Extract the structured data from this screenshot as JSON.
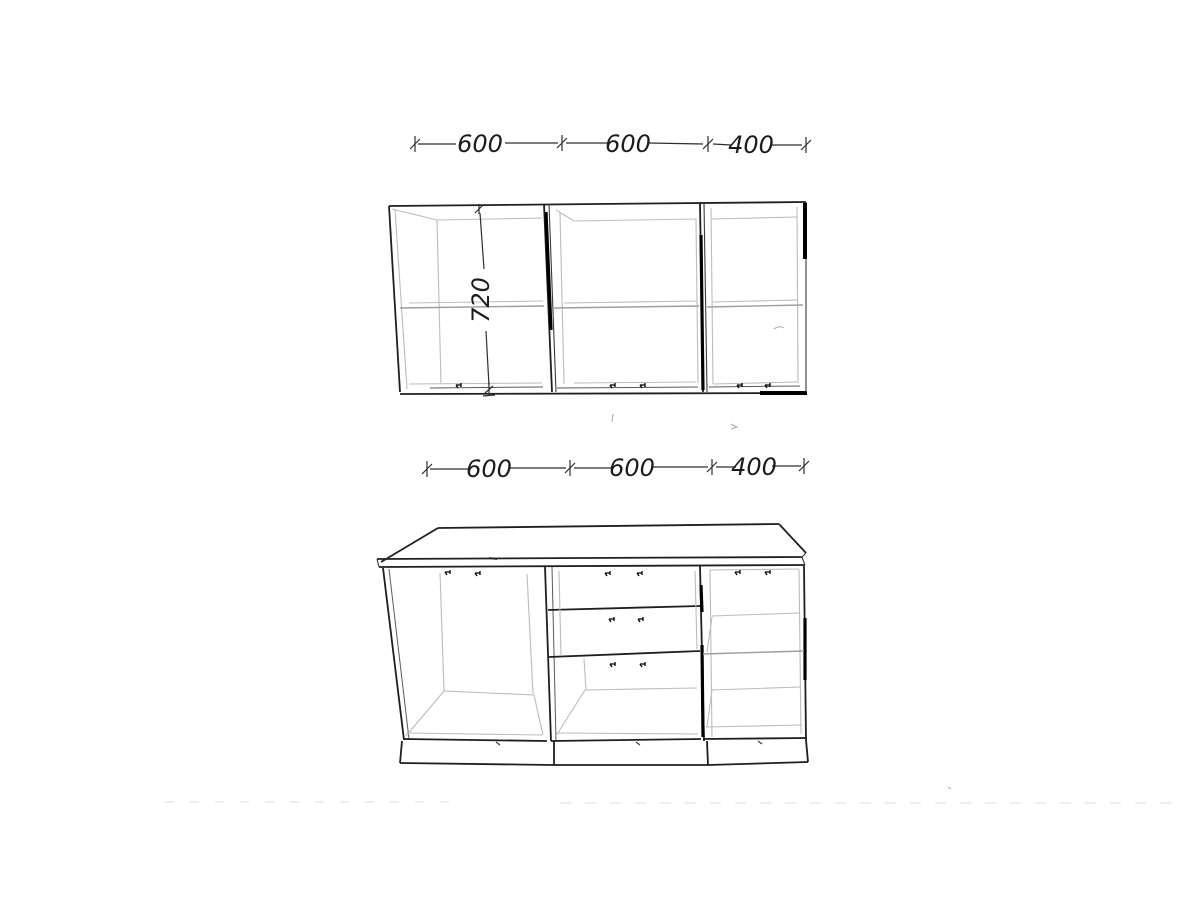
{
  "colors": {
    "background": "#ffffff",
    "line_dark": "#1f1f1f",
    "line_light": "#bcbcbc",
    "line_bold": "#000000",
    "text": "#1c1c1c"
  },
  "wall_run": {
    "dimension_labels": [
      "600",
      "600",
      "400"
    ],
    "height_label": "720"
  },
  "base_run": {
    "dimension_labels": [
      "600",
      "600",
      "400"
    ]
  }
}
